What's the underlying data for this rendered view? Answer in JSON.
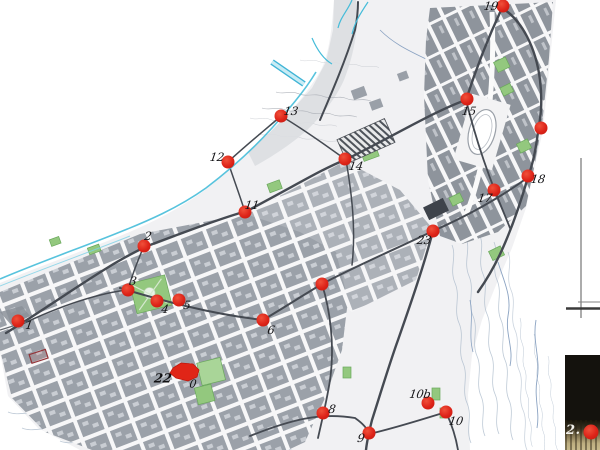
{
  "figure": {
    "type": "scanned city plan with numbered observation point markers and photo inset",
    "colors": {
      "marker_red": "#dd2318",
      "park_green": "#93c87e",
      "coast_cyan": "#45bcd9",
      "road_dark": "#454a52",
      "block_gray": "#9ba1a9",
      "contour_blue_gray": "#a9b8c9",
      "inset_background": "#14120d"
    },
    "markers": [
      {
        "label": "1",
        "x": 18,
        "y": 321,
        "lx": 29,
        "ly": 325
      },
      {
        "label": "2",
        "x": 144,
        "y": 246,
        "lx": 148,
        "ly": 236
      },
      {
        "label": "3",
        "x": 128,
        "y": 290,
        "lx": 133,
        "ly": 281
      },
      {
        "label": "4",
        "x": 157,
        "y": 301,
        "lx": 165,
        "ly": 309
      },
      {
        "label": "5",
        "x": 179,
        "y": 300,
        "lx": 187,
        "ly": 305
      },
      {
        "label": "6",
        "x": 263,
        "y": 320,
        "lx": 271,
        "ly": 330
      },
      {
        "label": "",
        "x": 322,
        "y": 284
      },
      {
        "label": "8",
        "x": 323,
        "y": 413,
        "lx": 332,
        "ly": 409
      },
      {
        "label": "9",
        "x": 369,
        "y": 433,
        "lx": 361,
        "ly": 438
      },
      {
        "label": "10",
        "x": 446,
        "y": 412,
        "lx": 456,
        "ly": 421
      },
      {
        "label": "10b",
        "x": 428,
        "y": 403,
        "lx": 420,
        "ly": 394
      },
      {
        "label": "11",
        "x": 245,
        "y": 212,
        "lx": 252,
        "ly": 205
      },
      {
        "label": "12",
        "x": 228,
        "y": 162,
        "lx": 217,
        "ly": 157
      },
      {
        "label": "13",
        "x": 281,
        "y": 116,
        "lx": 291,
        "ly": 111
      },
      {
        "label": "14",
        "x": 345,
        "y": 159,
        "lx": 356,
        "ly": 166
      },
      {
        "label": "15",
        "x": 467,
        "y": 99,
        "lx": 469,
        "ly": 111
      },
      {
        "label": "",
        "x": 541,
        "y": 128
      },
      {
        "label": "17",
        "x": 494,
        "y": 190,
        "lx": 485,
        "ly": 198
      },
      {
        "label": "18",
        "x": 528,
        "y": 176,
        "lx": 538,
        "ly": 179
      },
      {
        "label": "19",
        "x": 503,
        "y": 6,
        "lx": 491,
        "ly": 6
      },
      {
        "label": "23",
        "x": 433,
        "y": 231,
        "lx": 424,
        "ly": 240
      },
      {
        "label": "",
        "x": 591,
        "y": 432,
        "s": 15
      }
    ],
    "area_marker": {
      "label": "22",
      "secondary_label": "0"
    },
    "inset_photo": {
      "label": "2."
    }
  }
}
